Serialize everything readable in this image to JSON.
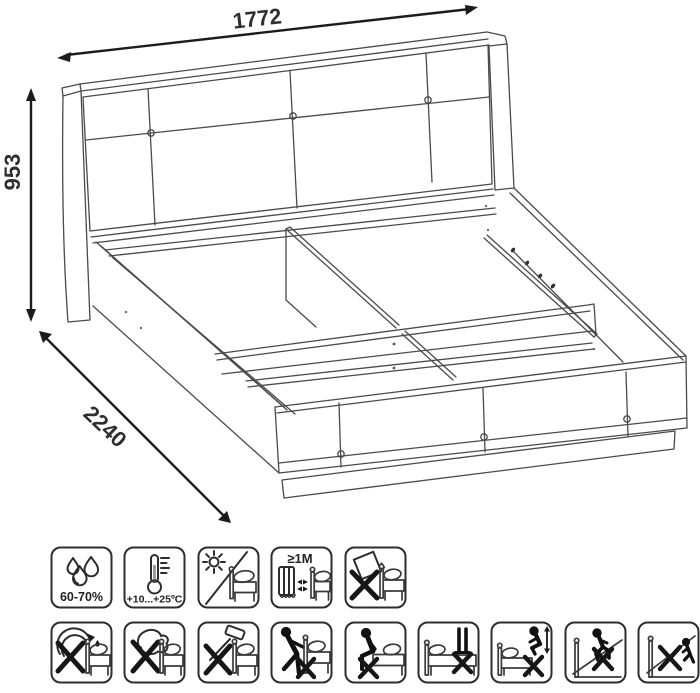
{
  "drawing": {
    "dimensions": {
      "width_mm": "1772",
      "height_mm": "953",
      "length_mm": "2240"
    },
    "line_color": "#4a4a4a",
    "arrow_color": "#1c1c1c",
    "background": "#ffffff"
  },
  "icons": {
    "row1": [
      {
        "name": "humidity-range-icon",
        "label": "60-70%"
      },
      {
        "name": "temperature-range-icon",
        "label": "+10...+25ºC"
      },
      {
        "name": "no-direct-sunlight-icon"
      },
      {
        "name": "min-distance-from-heat-icon",
        "label": "≥1M"
      },
      {
        "name": "no-tilting-wet-objects-icon"
      }
    ],
    "row2": [
      {
        "name": "no-pouring-liquids-icon"
      },
      {
        "name": "no-wet-cloth-icon"
      },
      {
        "name": "no-hammering-icon"
      },
      {
        "name": "no-dragging-icon"
      },
      {
        "name": "no-sitting-on-edge-icon"
      },
      {
        "name": "no-standing-on-bed-icon"
      },
      {
        "name": "no-jumping-on-bed-icon"
      },
      {
        "name": "no-walking-on-lifted-base-icon"
      },
      {
        "name": "no-load-on-lifted-base-icon"
      }
    ]
  }
}
